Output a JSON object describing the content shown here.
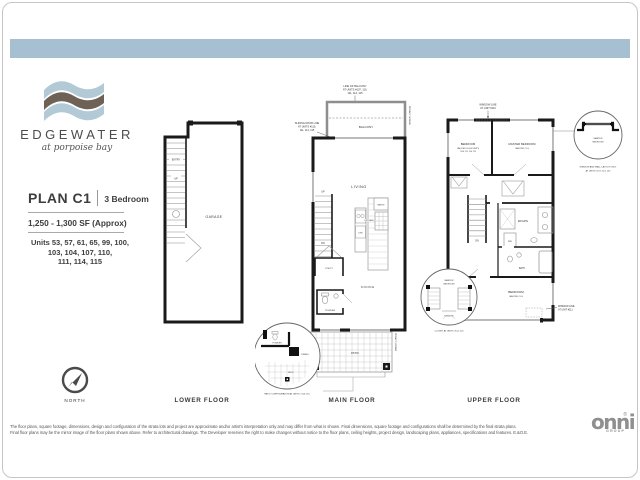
{
  "brand": {
    "name": "EDGEWATER",
    "tagline": "at porpoise bay"
  },
  "plan": {
    "name": "PLAN C1",
    "type": "3 Bedroom",
    "size": "1,250 - 1,300 SF (Approx)",
    "units": [
      "Units 53, 57, 61, 65, 99, 100,",
      "103, 104, 107, 110,",
      "111, 114, 115"
    ]
  },
  "compass": {
    "label": "NORTH"
  },
  "lower": {
    "label": "LOWER FLOOR",
    "garage": "GARAGE",
    "entry": "ENTRY",
    "up": "UP"
  },
  "main": {
    "label": "MAIN FLOOR",
    "balcony": "BALCONY",
    "living": "LIVING",
    "kitchen": "KITCHEN",
    "pantry": "PANTRY",
    "dw": "D/W",
    "utility": "UTILITY",
    "powder": "POWDER",
    "dining": "DINING",
    "patio": "PATIO",
    "up": "UP",
    "dn": "DN",
    "privacy_screen": "PRIVACY SCREEN",
    "balcony_note": [
      "LINE OF BALCONY",
      "AT UNITS #107, 110,",
      "111, 114, 115"
    ],
    "sliding_note": [
      "SLIDING DOOR LINE",
      "AT UNITS #110,",
      "111, 114, 115"
    ],
    "patio_note": "PATIO CONFIGURATION AT UNITS #114, 115",
    "inset": {
      "powder": "POWDER",
      "dining": "DINING",
      "patio": "PATIO"
    }
  },
  "upper": {
    "label": "UPPER FLOOR",
    "bedroom2": "BEDROOM",
    "bedroom2_sub1": "VAULTED CLG AT UNITS",
    "bedroom2_sub2": "#110, 111, 114, 115",
    "master": "MASTER BEDROOM",
    "master_sub": "VAULTED CLG",
    "bedroom3": "BEDROOM",
    "bedroom3_sub": "VAULTED CLG",
    "ensuite": "ENSUITE",
    "bath": "BATH",
    "wd": "W/D",
    "dn": "DN",
    "window_note_top1": "WINDOW LINE",
    "window_note_top2": "AT UNIT #110",
    "window_note_right1": "WINDOW LINE",
    "window_note_right2": "AT UNIT #111",
    "inset1": {
      "master1": "MASTER",
      "master2": "BEDROOM",
      "ensuite": "ENSUITE",
      "caption": "CLOSET AT UNITS #114, 115"
    },
    "inset2": {
      "master1": "MASTER",
      "master2": "BEDROOM",
      "caption1": "WINDOW AND WALL LAYOUT ONLY",
      "caption2": "AT UNITS #107, 114, 115"
    }
  },
  "footer": {
    "disclaimer1": "The floor plans, square footage, dimensions, design and configuration of the strata lots and project are approximate and/or artist's interpretation only and may differ from what is shown.  Final dimensions, square footage and configurations shall be determined by the final strata plans.",
    "disclaimer2": "Final floor plans may be the mirror image of the floor plans shown above.  Refer to architectural drawings.  The Developer reserves the right to make changes without notice to the floor plans, ceiling heights, project design, landscaping plans, appliances, specifications and features.  E.&O.E.",
    "logo": "onni",
    "logo_sub": "GROUP",
    "logo_mark": "®"
  }
}
